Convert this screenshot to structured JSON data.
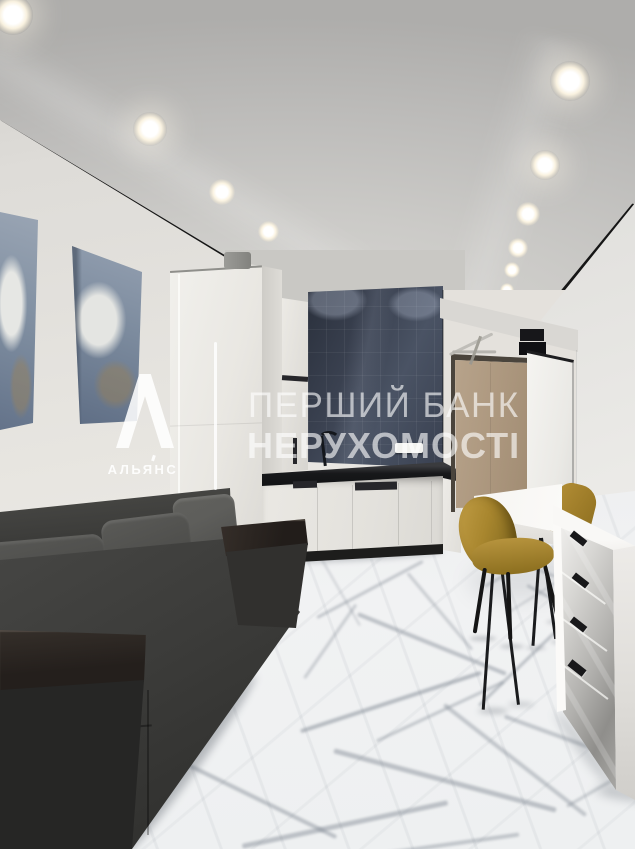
{
  "watermark": {
    "logo_letter": "А",
    "logo_name": "АЛЬЯНС",
    "line1": "ПЕРШИЙ БАНК",
    "line2": "НЕРУХОМОСТІ",
    "text_color": "#ffffff"
  },
  "scene_palette": {
    "ceiling": "#c6c5c3",
    "walls": "#e6e4e0",
    "backsplash_tiles": "#3d4452",
    "countertop": "#1b1c1e",
    "kitchen_cabinets": "#eceae6",
    "sofa_fabric": "#434240",
    "sofa_wood_armrest": "#2a2522",
    "chairs_velvet": "#a8862e",
    "entrance_door": "#b19d85",
    "dresser": "#f2f1ee",
    "floor_marble": "#eceeef",
    "floor_veins": "#8d949c"
  }
}
